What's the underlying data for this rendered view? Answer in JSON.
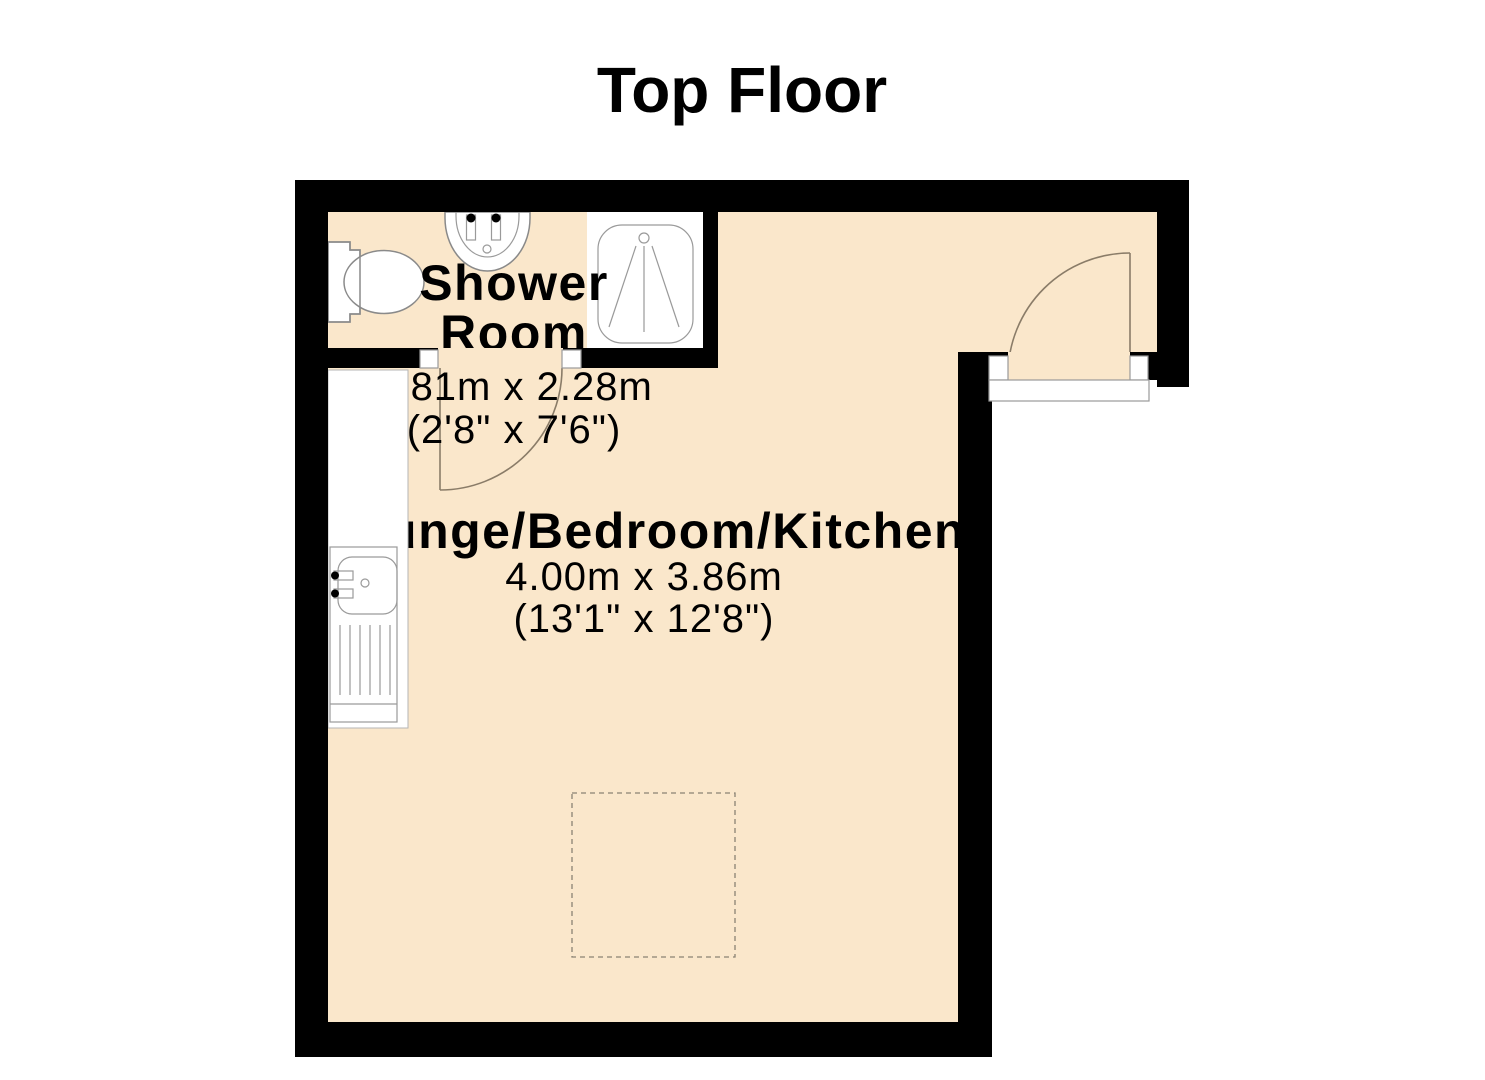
{
  "title": "Top Floor",
  "colors": {
    "floor": "#FAE7CB",
    "wall": "#000000",
    "door_swing": "#8a7c68",
    "fixture_outline": "#8a8a8a"
  },
  "rooms": {
    "shower_room": {
      "name_line1": "Shower",
      "name_line2": "Room",
      "size_metric": "0.81m x 2.28m",
      "size_imperial": "(2'8\" x 7'6\")"
    },
    "lounge_bedroom_kitchen": {
      "name": "Lounge/Bedroom/Kitchen",
      "size_metric": "4.00m x 3.86m",
      "size_imperial": "(13'1\" x 12'8\")"
    }
  },
  "fixtures": [
    "toilet",
    "wash-basin",
    "shower-enclosure",
    "kitchen-sink-drainer",
    "bed-position",
    "entry-door",
    "shower-room-door"
  ]
}
